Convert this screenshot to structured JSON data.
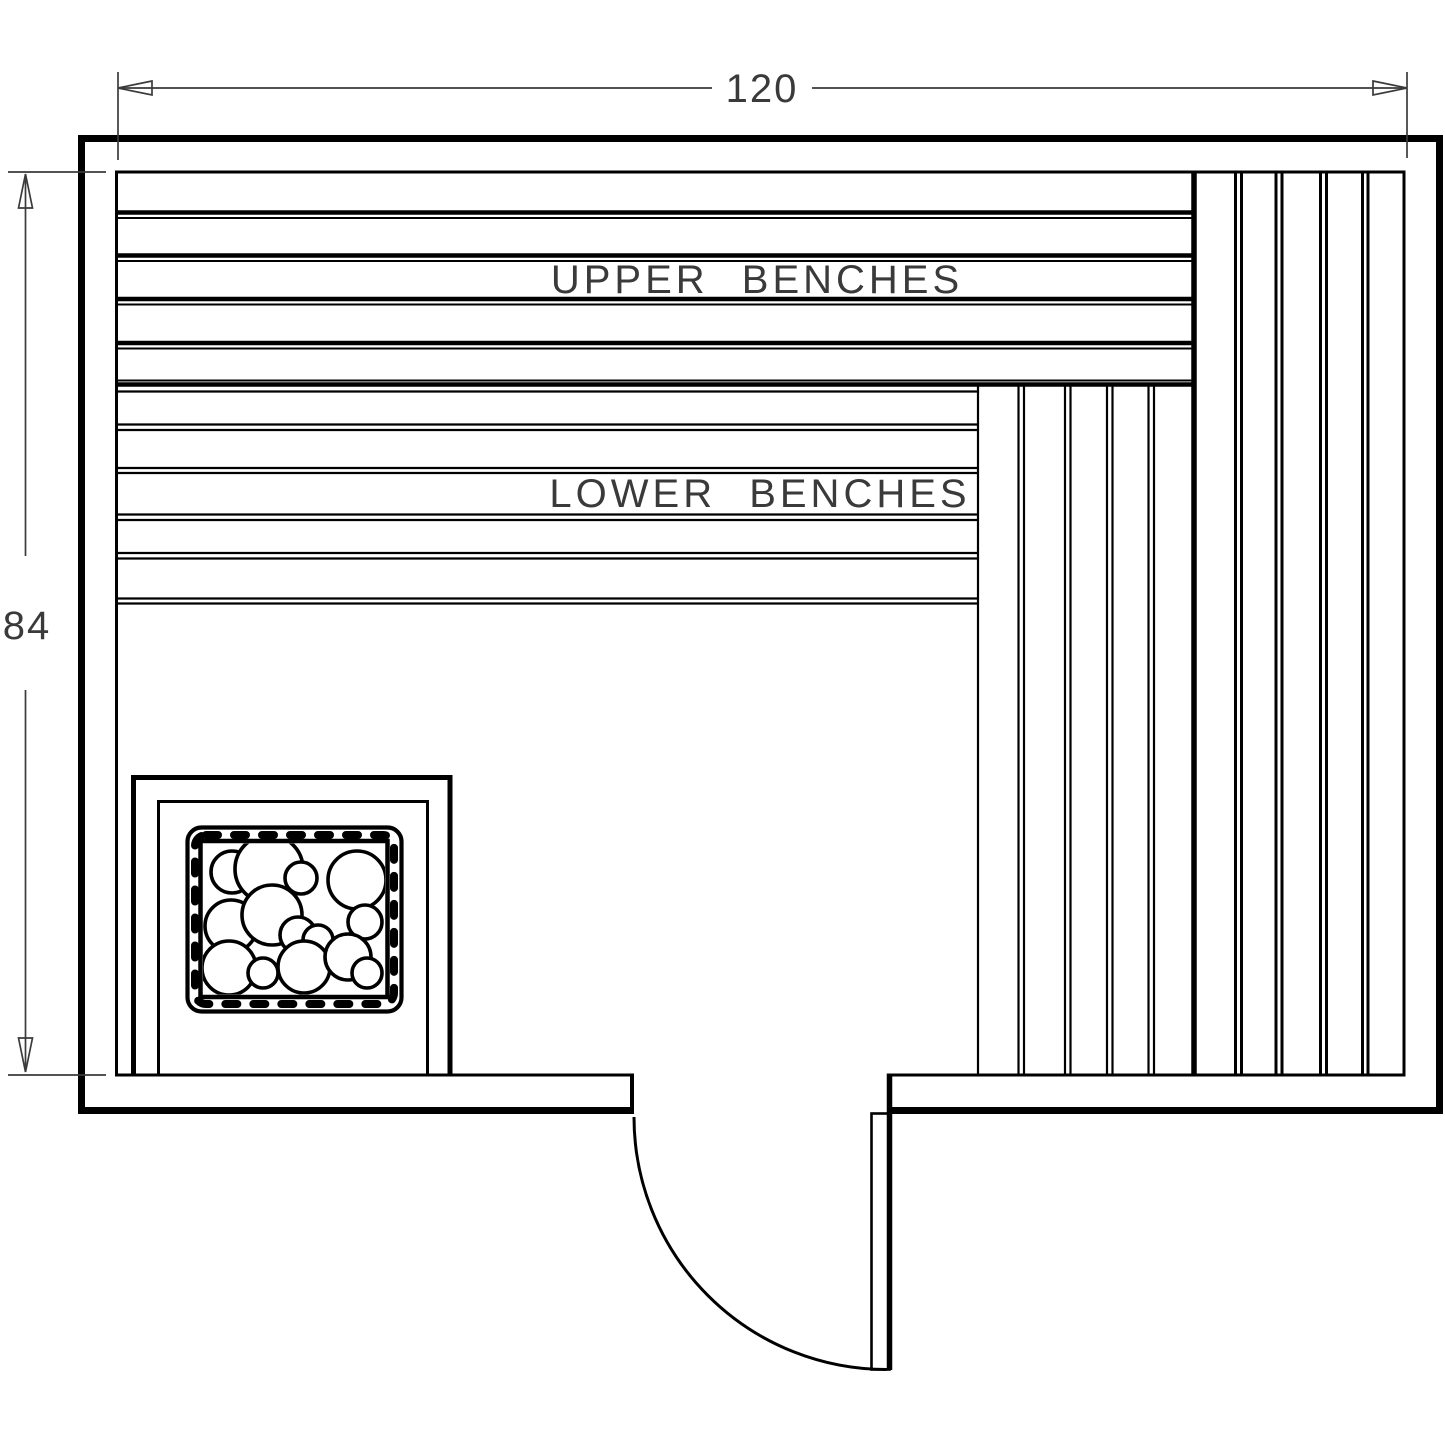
{
  "labels": {
    "width_dimension": "120",
    "height_dimension": "84",
    "upper_benches": "UPPER BENCHES",
    "lower_benches": "LOWER BENCHES"
  },
  "colors": {
    "line": "#000000",
    "dimension": "#3a3a3a",
    "label_text": "#3a3a3a",
    "background": "#ffffff"
  }
}
